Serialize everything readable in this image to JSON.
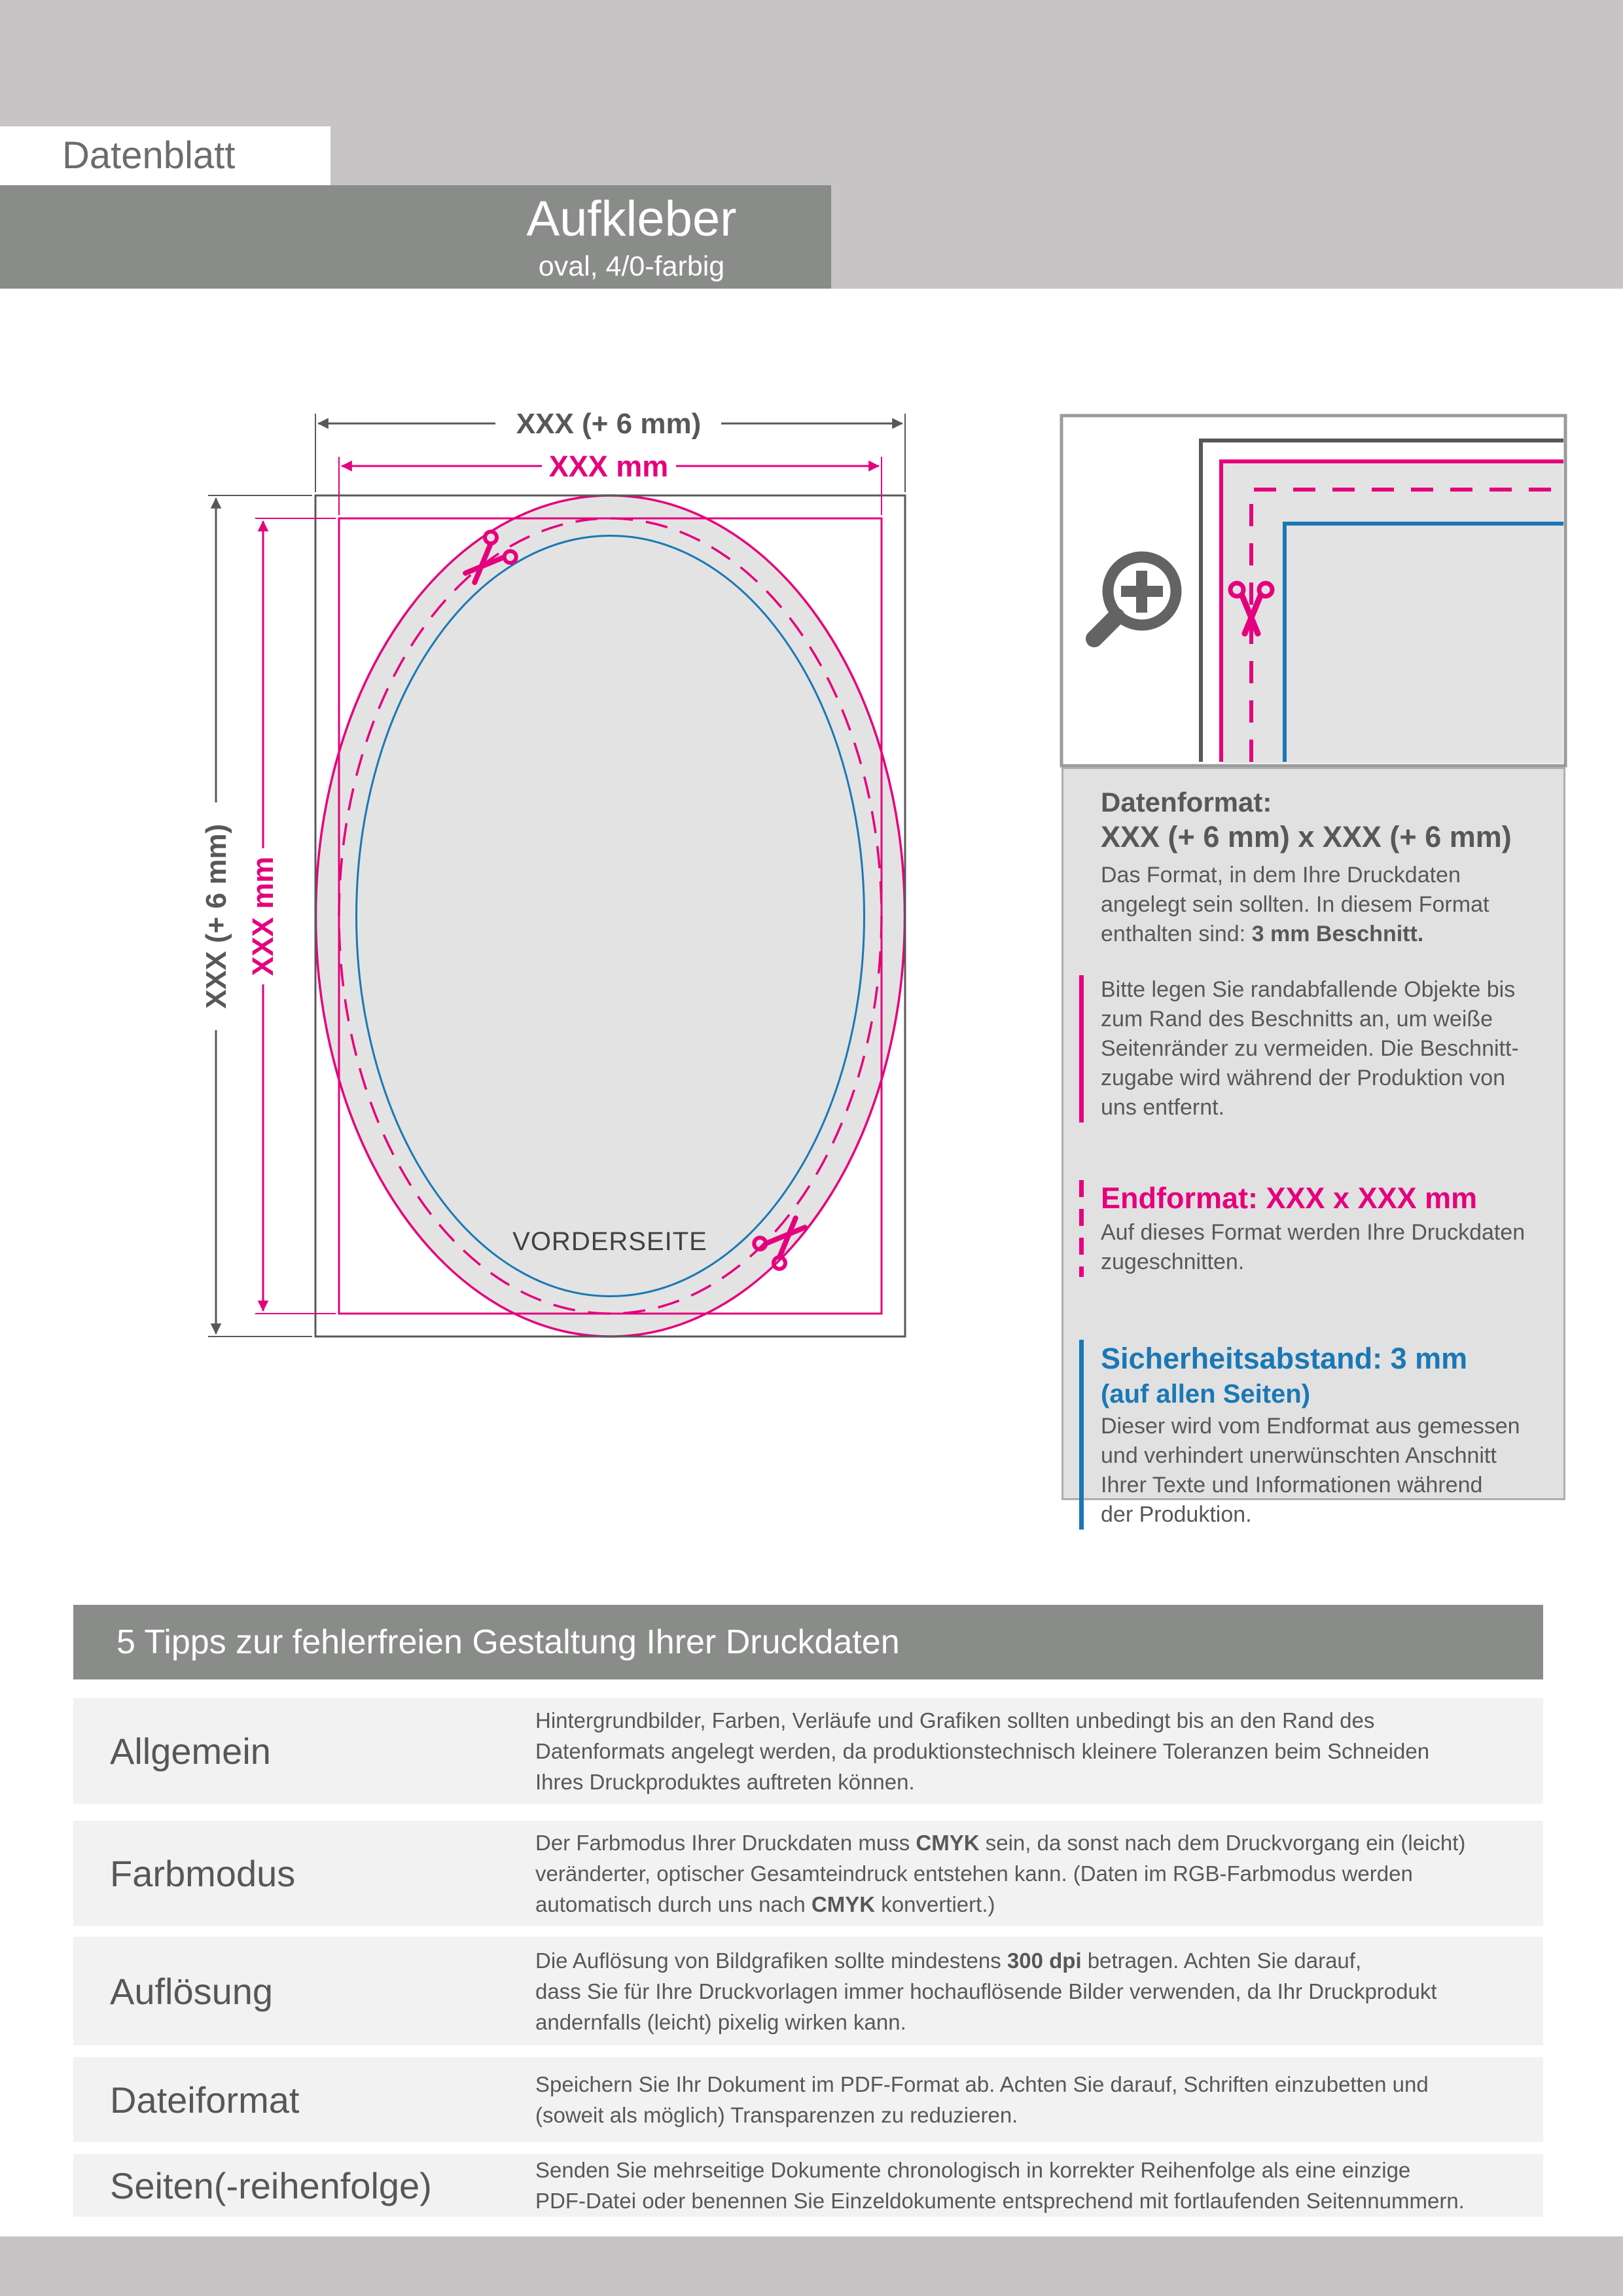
{
  "header": {
    "sheet_label": "Datenblatt",
    "banner": {
      "title": "Aufkleber",
      "subtitle": "oval, 4/0-farbig"
    }
  },
  "diagram": {
    "dim_width_outer": "XXX (+ 6 mm)",
    "dim_width_inner": "XXX mm",
    "dim_height_outer": "XXX (+ 6 mm)",
    "dim_height_inner": "XXX mm",
    "front_label": "VORDERSEITE",
    "colors": {
      "outline_gray": "#58585a",
      "magenta": "#e5007d",
      "blue": "#1a78b5",
      "sticker_fill": "#e3e3e3"
    }
  },
  "info_panel": {
    "datenformat": {
      "heading": "Datenformat:",
      "format_line": "XXX (+ 6 mm) x XXX (+ 6 mm)",
      "body_prefix": "Das Format, in dem Ihre Druckdaten\nangelegt sein sollten. In diesem Format\nenthalten sind: ",
      "body_bold": "3 mm Beschnitt."
    },
    "bleed_note": "Bitte legen Sie randabfallende Objekte bis\nzum Rand des Beschnitts an, um weiße\nSeitenränder zu vermeiden. Die Beschnitt-\nzugabe wird während der Produktion von\nuns entfernt.",
    "endformat": {
      "heading": "Endformat: XXX x XXX mm",
      "body": "Auf dieses Format werden Ihre Druckdaten\nzugeschnitten."
    },
    "sicherheitsabstand": {
      "heading": "Sicherheitsabstand: 3 mm",
      "subheading": "(auf allen Seiten)",
      "body": "Dieser wird vom Endformat aus gemessen\nund verhindert unerwünschten Anschnitt\nIhrer Texte und Informationen während\nder Produktion."
    }
  },
  "tips": {
    "banner": "5 Tipps zur fehlerfreien Gestaltung Ihrer Druckdaten",
    "rows": [
      {
        "title": "Allgemein",
        "body": "Hintergrundbilder, Farben, Verläufe und Grafiken sollten unbedingt bis an den Rand des\nDatenformats angelegt werden, da produktionstechnisch kleinere Toleranzen beim Schneiden\nIhres Druckproduktes auftreten können."
      },
      {
        "title": "Farbmodus",
        "body_parts": [
          "Der Farbmodus Ihrer Druckdaten muss ",
          "CMYK",
          " sein, da sonst nach dem Druckvorgang ein (leicht)\nveränderter, optischer Gesamteindruck entstehen kann. (Daten im RGB-Farbmodus werden\nautomatisch durch uns nach ",
          "CMYK",
          " konvertiert.)"
        ]
      },
      {
        "title": "Auflösung",
        "body_parts": [
          "Die Auflösung von Bildgrafiken sollte mindestens ",
          "300 dpi",
          " betragen. Achten Sie darauf,\ndass Sie für Ihre Druckvorlagen immer hochauflösende Bilder verwenden, da Ihr Druckprodukt\nandernfalls (leicht) pixelig wirken kann."
        ]
      },
      {
        "title": "Dateiformat",
        "body": "Speichern Sie Ihr Dokument im PDF-Format ab. Achten Sie darauf, Schriften einzubetten und\n(soweit als möglich) Transparenzen zu reduzieren."
      },
      {
        "title": "Seiten(-reihenfolge)",
        "body": "Senden Sie mehrseitige Dokumente chronologisch in korrekter Reihenfolge als eine einzige\nPDF-Datei oder benennen Sie Einzeldokumente entsprechend mit fortlaufenden Seitennummern."
      }
    ]
  }
}
